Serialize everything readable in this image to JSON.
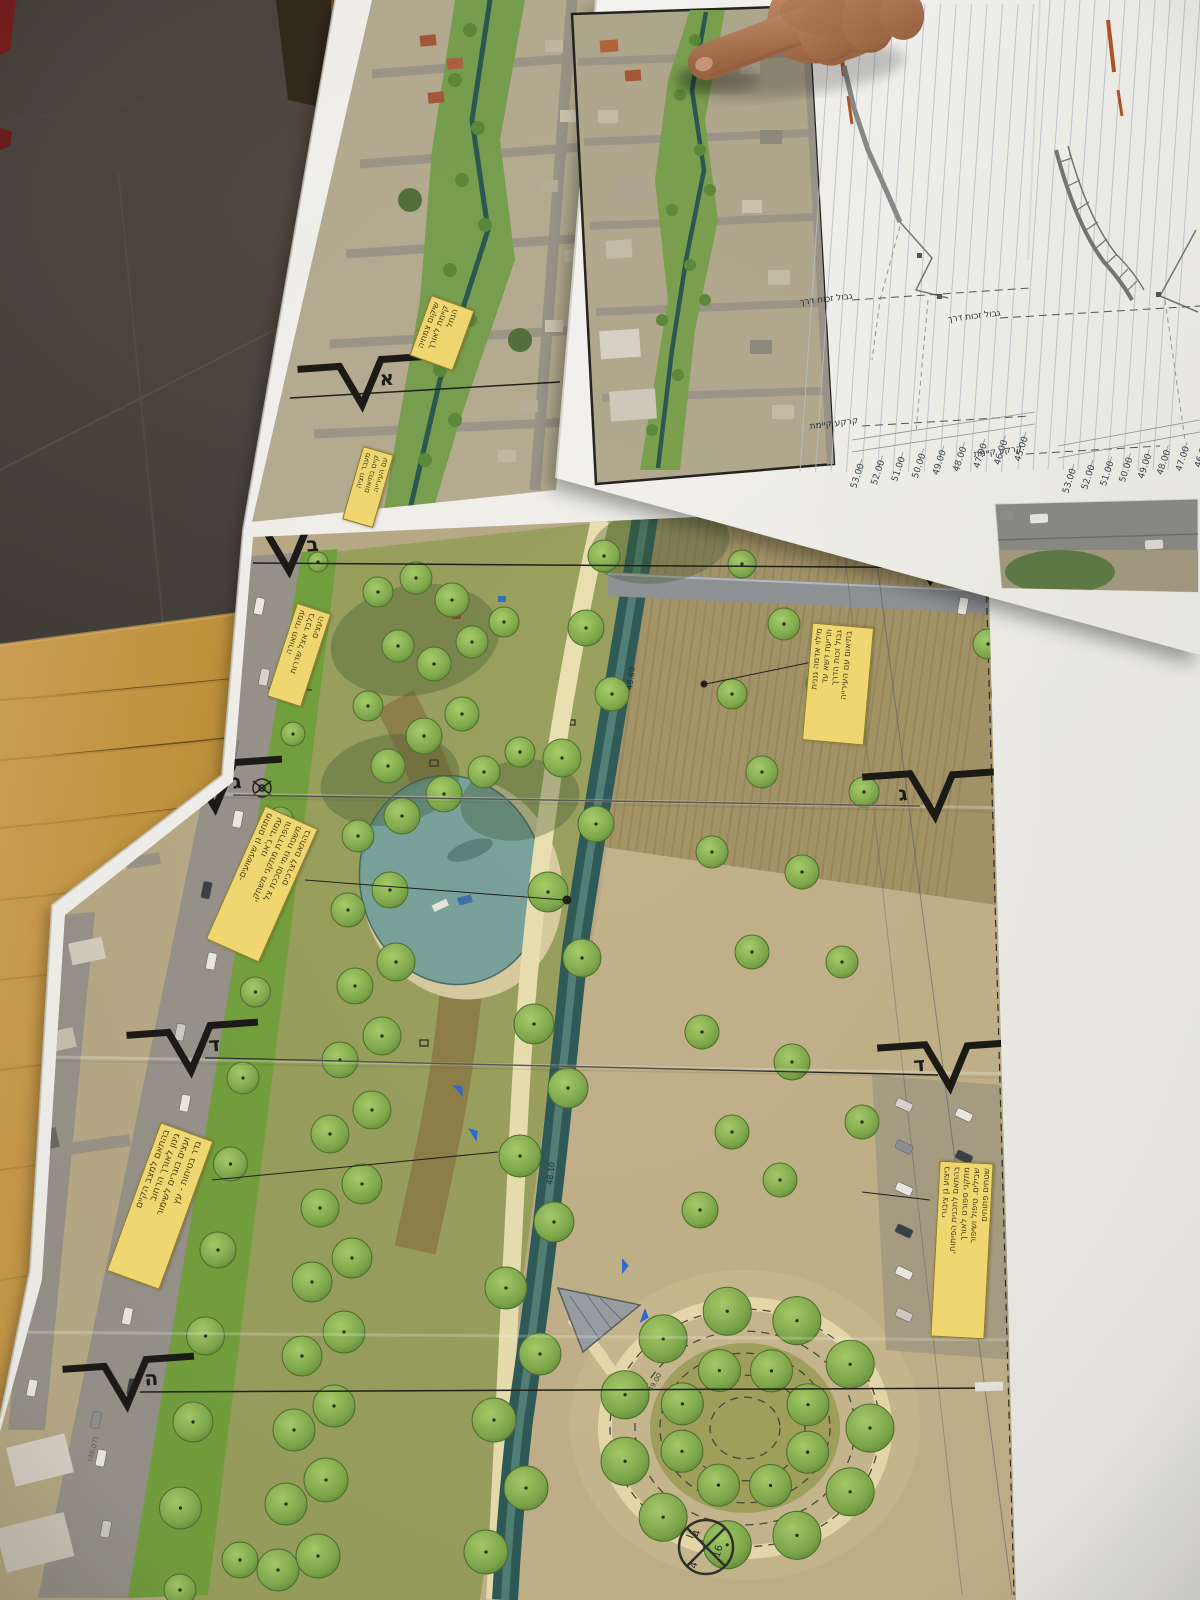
{
  "right_sheet": {
    "profiles": [
      {
        "boundary_label": "גבול זכות דרך",
        "ground_label": "קרקע קיימת",
        "elevation_scale": [
          "53.00",
          "52.00",
          "51.00",
          "50.00",
          "49.00",
          "48.00",
          "47.00",
          "46.00",
          "45.00"
        ]
      },
      {
        "boundary_label": "גבול זכות דרך",
        "ground_label": "קרקע קיימת",
        "elevation_scale": [
          "53.00",
          "52.00",
          "51.00",
          "50.00",
          "49.00",
          "48.00",
          "47.00",
          "46.00"
        ]
      }
    ]
  },
  "plan": {
    "section_markers": [
      {
        "letter": "א"
      },
      {
        "letter": "ב"
      },
      {
        "letter": "ב"
      },
      {
        "letter": "ג"
      },
      {
        "letter": "ג"
      },
      {
        "letter": "ד"
      },
      {
        "letter": "ד"
      },
      {
        "letter": "ה"
      }
    ],
    "notes": [
      {
        "text": "שיקום צמחיה\nקיימת לאורך\nהנחל"
      },
      {
        "text": "מעבר חציה\nקיים בתיאום\nעם העירייה"
      },
      {
        "text": "עמודי תאורה\nבלבד אצל שדרות\nהעצים"
      },
      {
        "text": "מתחם גן שעשועים-\nעמודי ג'אנו\nוהפרדת מתקני משחק,\nמשטח גומי וסככת צל\nבהתאם לצרכים"
      },
      {
        "text": "בהתאם למצב הקיים\nגינון לאורך הרחוב\nועצים בוגרים לשימור\nגדר בטיחות - עץ"
      },
      {
        "text": "מילוי אדמה גננית\nוזריעת דשא עד\nגבול זכות הדרך\nבתיאום עם העירייה"
      },
      {
        "text": "ביצוע גן ציבורי\nבהתאם לתכנית הפיתוח,\nמתקני ספורט לאורך\nשבילים. טיפול ושיפור\nשטחים פתוחים"
      }
    ],
    "crossing_symbol": {
      "top": "4",
      "right": "16",
      "bottom": "4"
    },
    "channel_labels": [
      "48.60",
      "48.10"
    ],
    "contour_label": "49.00",
    "spot_elevations": [
      "(48.25)",
      "(48.07)"
    ]
  },
  "palette": {
    "paper": "#f3f2ee",
    "floor": "#46403a",
    "table_wood": "#c59a4b",
    "cabinet_wood": "#7d4a1e",
    "note_yellow": "#f0d671",
    "channel_teal": "#2f5b58",
    "lawn_green": "#74a13e",
    "tree_green": "#7fa94c",
    "path_cream": "#eadfb0",
    "aerial_tan": "#b3a98c",
    "road_gray": "#98948b",
    "skin": "#b57a57"
  }
}
